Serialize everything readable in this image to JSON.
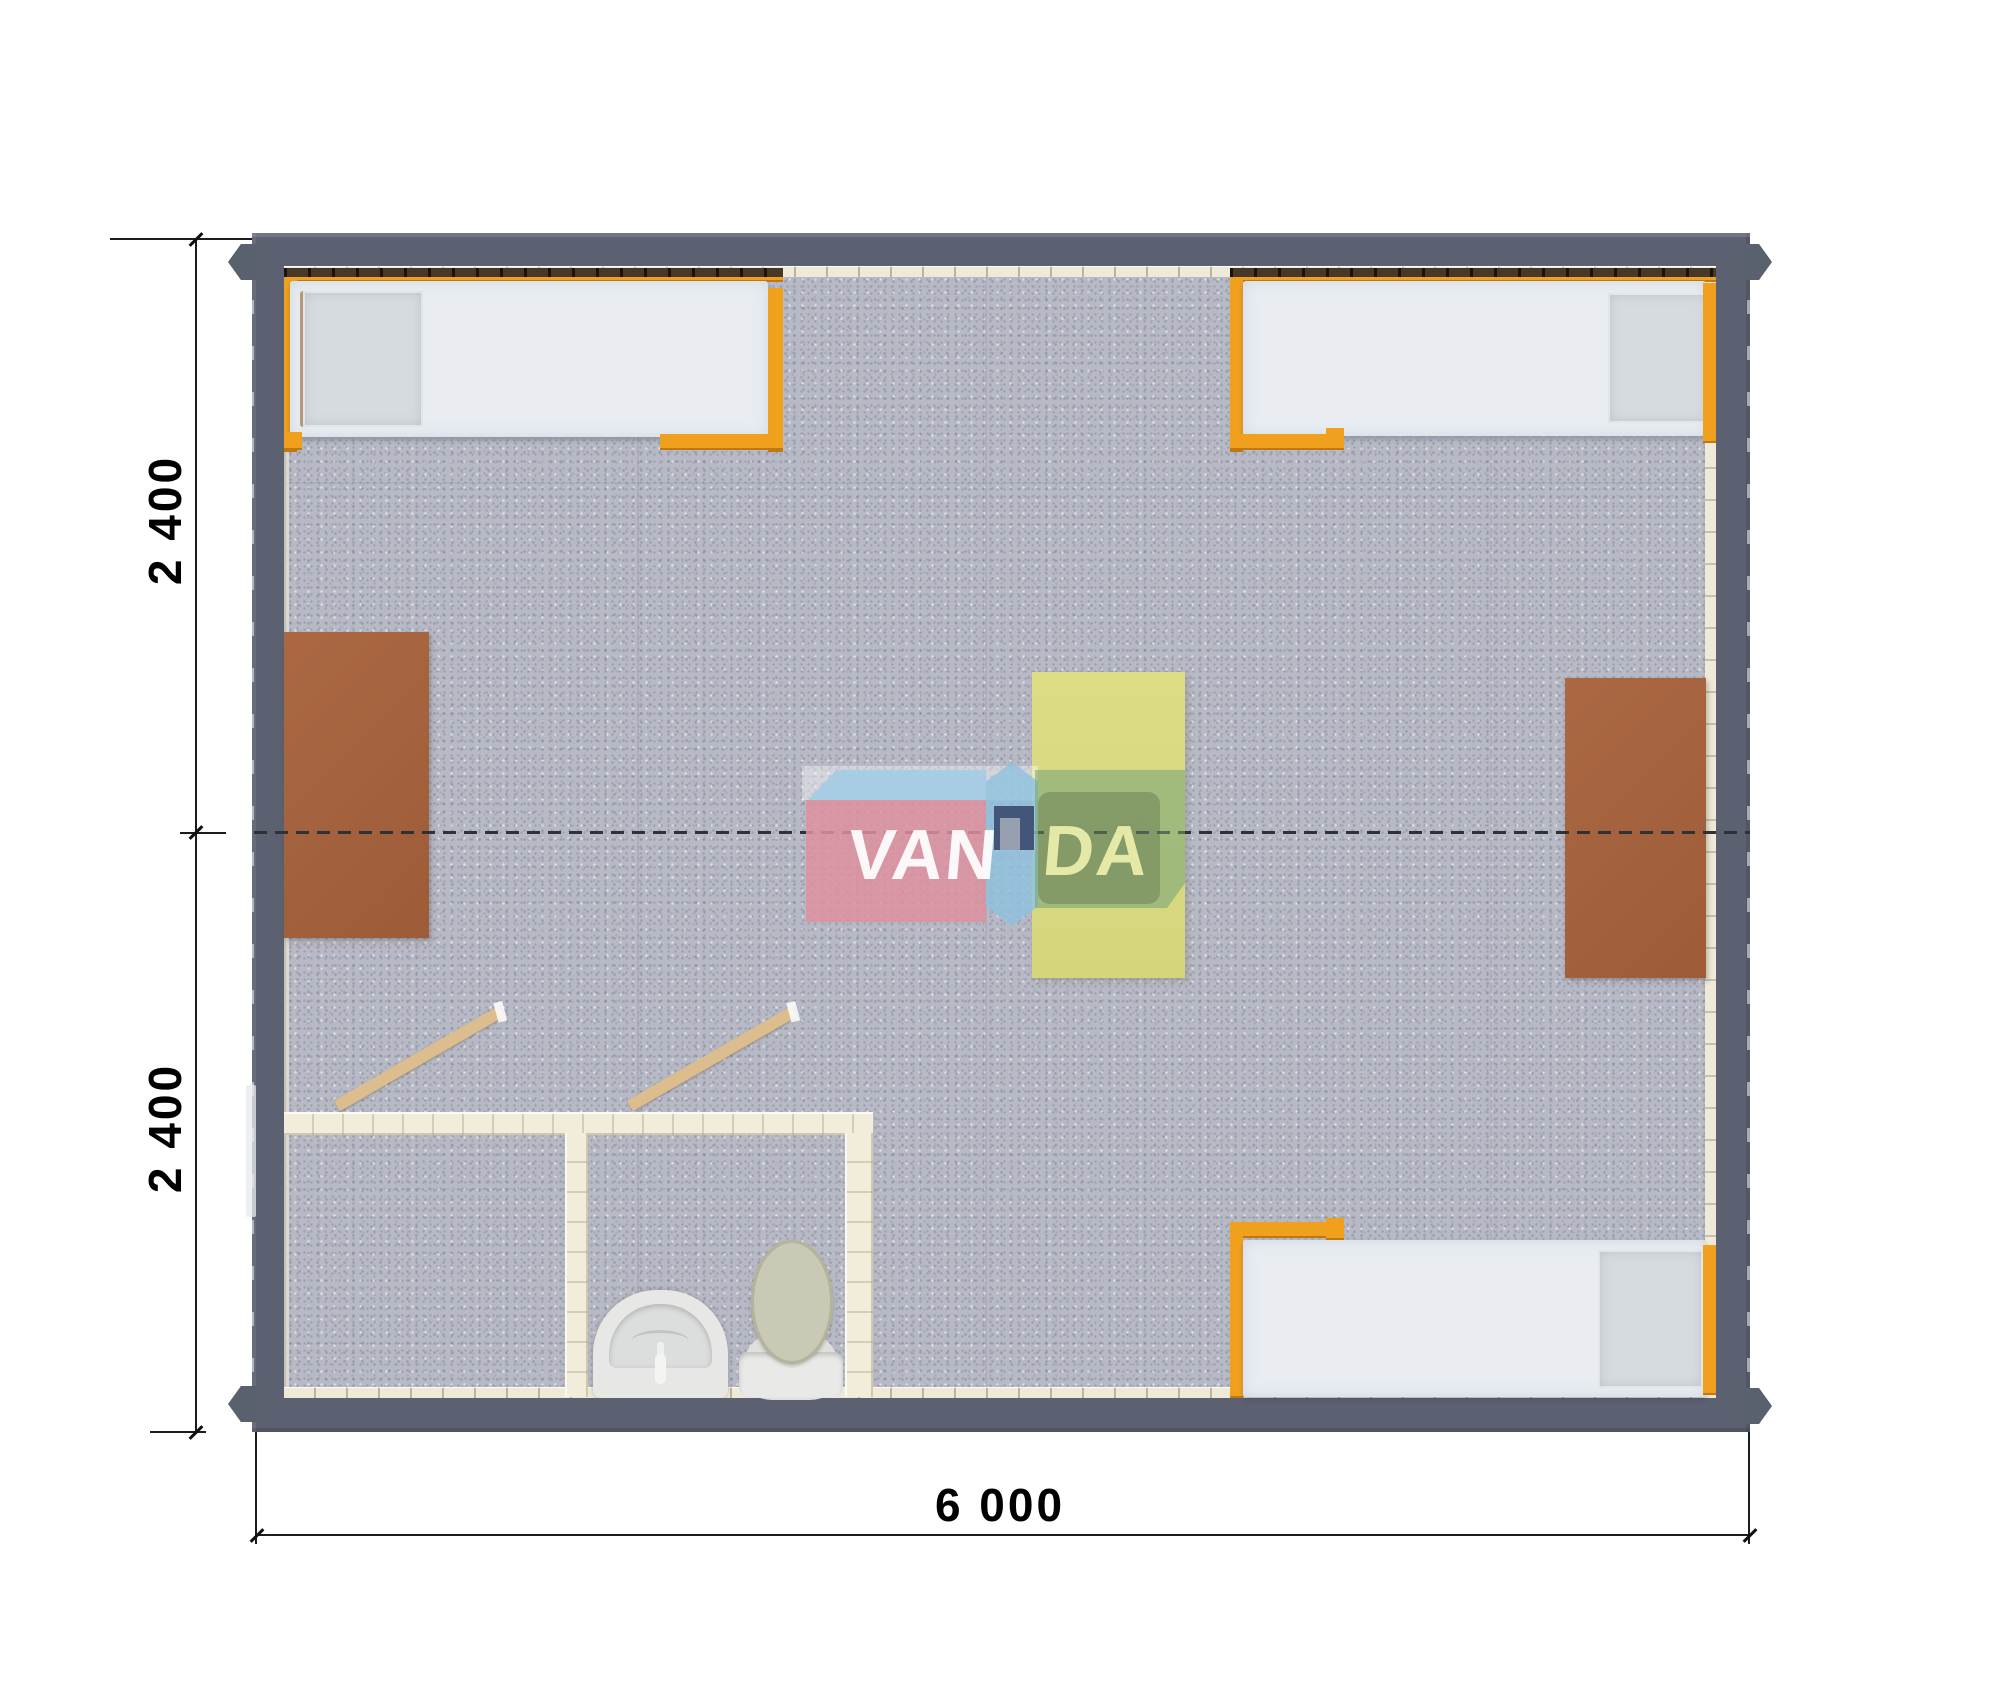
{
  "drawing": {
    "type": "floor-plan-top-view-render",
    "dimensions": {
      "left_module_top": "2 400",
      "left_module_bottom": "2 400",
      "bottom_total": "6 000"
    },
    "watermark": {
      "text_left": "VAN",
      "text_right": "DA",
      "full": "VANDA"
    },
    "colors": {
      "wall_gray": "#5b6170",
      "liner_cream": "#efe9d8",
      "carpet_gray": "#b7b9c5",
      "bed_frame_orange": "#efa11d",
      "mattress_white": "#e9edf2",
      "desk_brown": "#a5613d",
      "table_yellow": "#d9da81",
      "bathroom_wall_cream": "#f2edda",
      "door_wood": "#dcbd8e",
      "fixture_white": "#e7e8e6",
      "toilet_lid_olive": "#c9c9b5",
      "watermark_pink": "#de91a0",
      "watermark_blue": "#8fc2de",
      "watermark_navy": "#3e5074",
      "watermark_green": "#72a278",
      "dimension_text": "#000000"
    }
  }
}
